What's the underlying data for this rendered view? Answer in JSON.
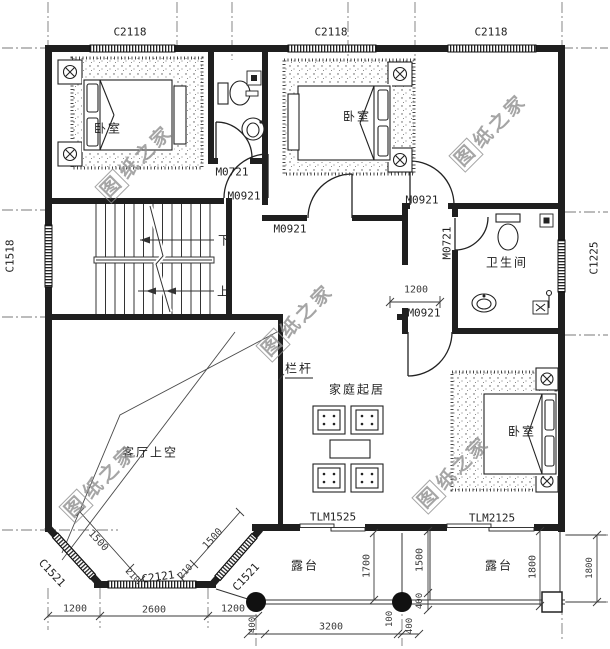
{
  "windows": {
    "top": [
      "C2118",
      "C2118",
      "C2118"
    ],
    "left": "C1518",
    "right": "C1225",
    "bay_left": "C1521",
    "bay_bottom": "C2121",
    "bay_right": "C1521"
  },
  "doors": {
    "bath_small": "M0721",
    "bath_main": "M0721",
    "m0921": [
      "M0921",
      "M0921",
      "M0921",
      "M0921"
    ],
    "terrace_family": "TLM1525",
    "terrace_bedroom": "TLM2125"
  },
  "rooms": {
    "bedroom1": "卧室",
    "bedroom2": "卧室",
    "bedroom3": "卧室",
    "bathroom": "卫生间",
    "family": "家庭起居",
    "living_void": "客厅上空",
    "terrace_left": "露台",
    "terrace_right": "露台",
    "railing": "栏杆"
  },
  "stairs": {
    "down": "下",
    "up": "上"
  },
  "dims": {
    "bottom_left": [
      "1200",
      "2600",
      "1200"
    ],
    "bottom_right": [
      "400",
      "3200",
      "100",
      "400"
    ],
    "terrace": [
      "1700",
      "1500",
      "400",
      "1800",
      "1800"
    ],
    "bay": [
      "1500",
      "210",
      "210",
      "1500"
    ],
    "corridor": "1200"
  },
  "watermark": {
    "first": "图",
    "rest": "纸之家"
  },
  "colors": {
    "line": "#1f1f1f",
    "dim": "#3a3a3a",
    "watermark": "#8f8f8f",
    "background": "#ffffff"
  }
}
